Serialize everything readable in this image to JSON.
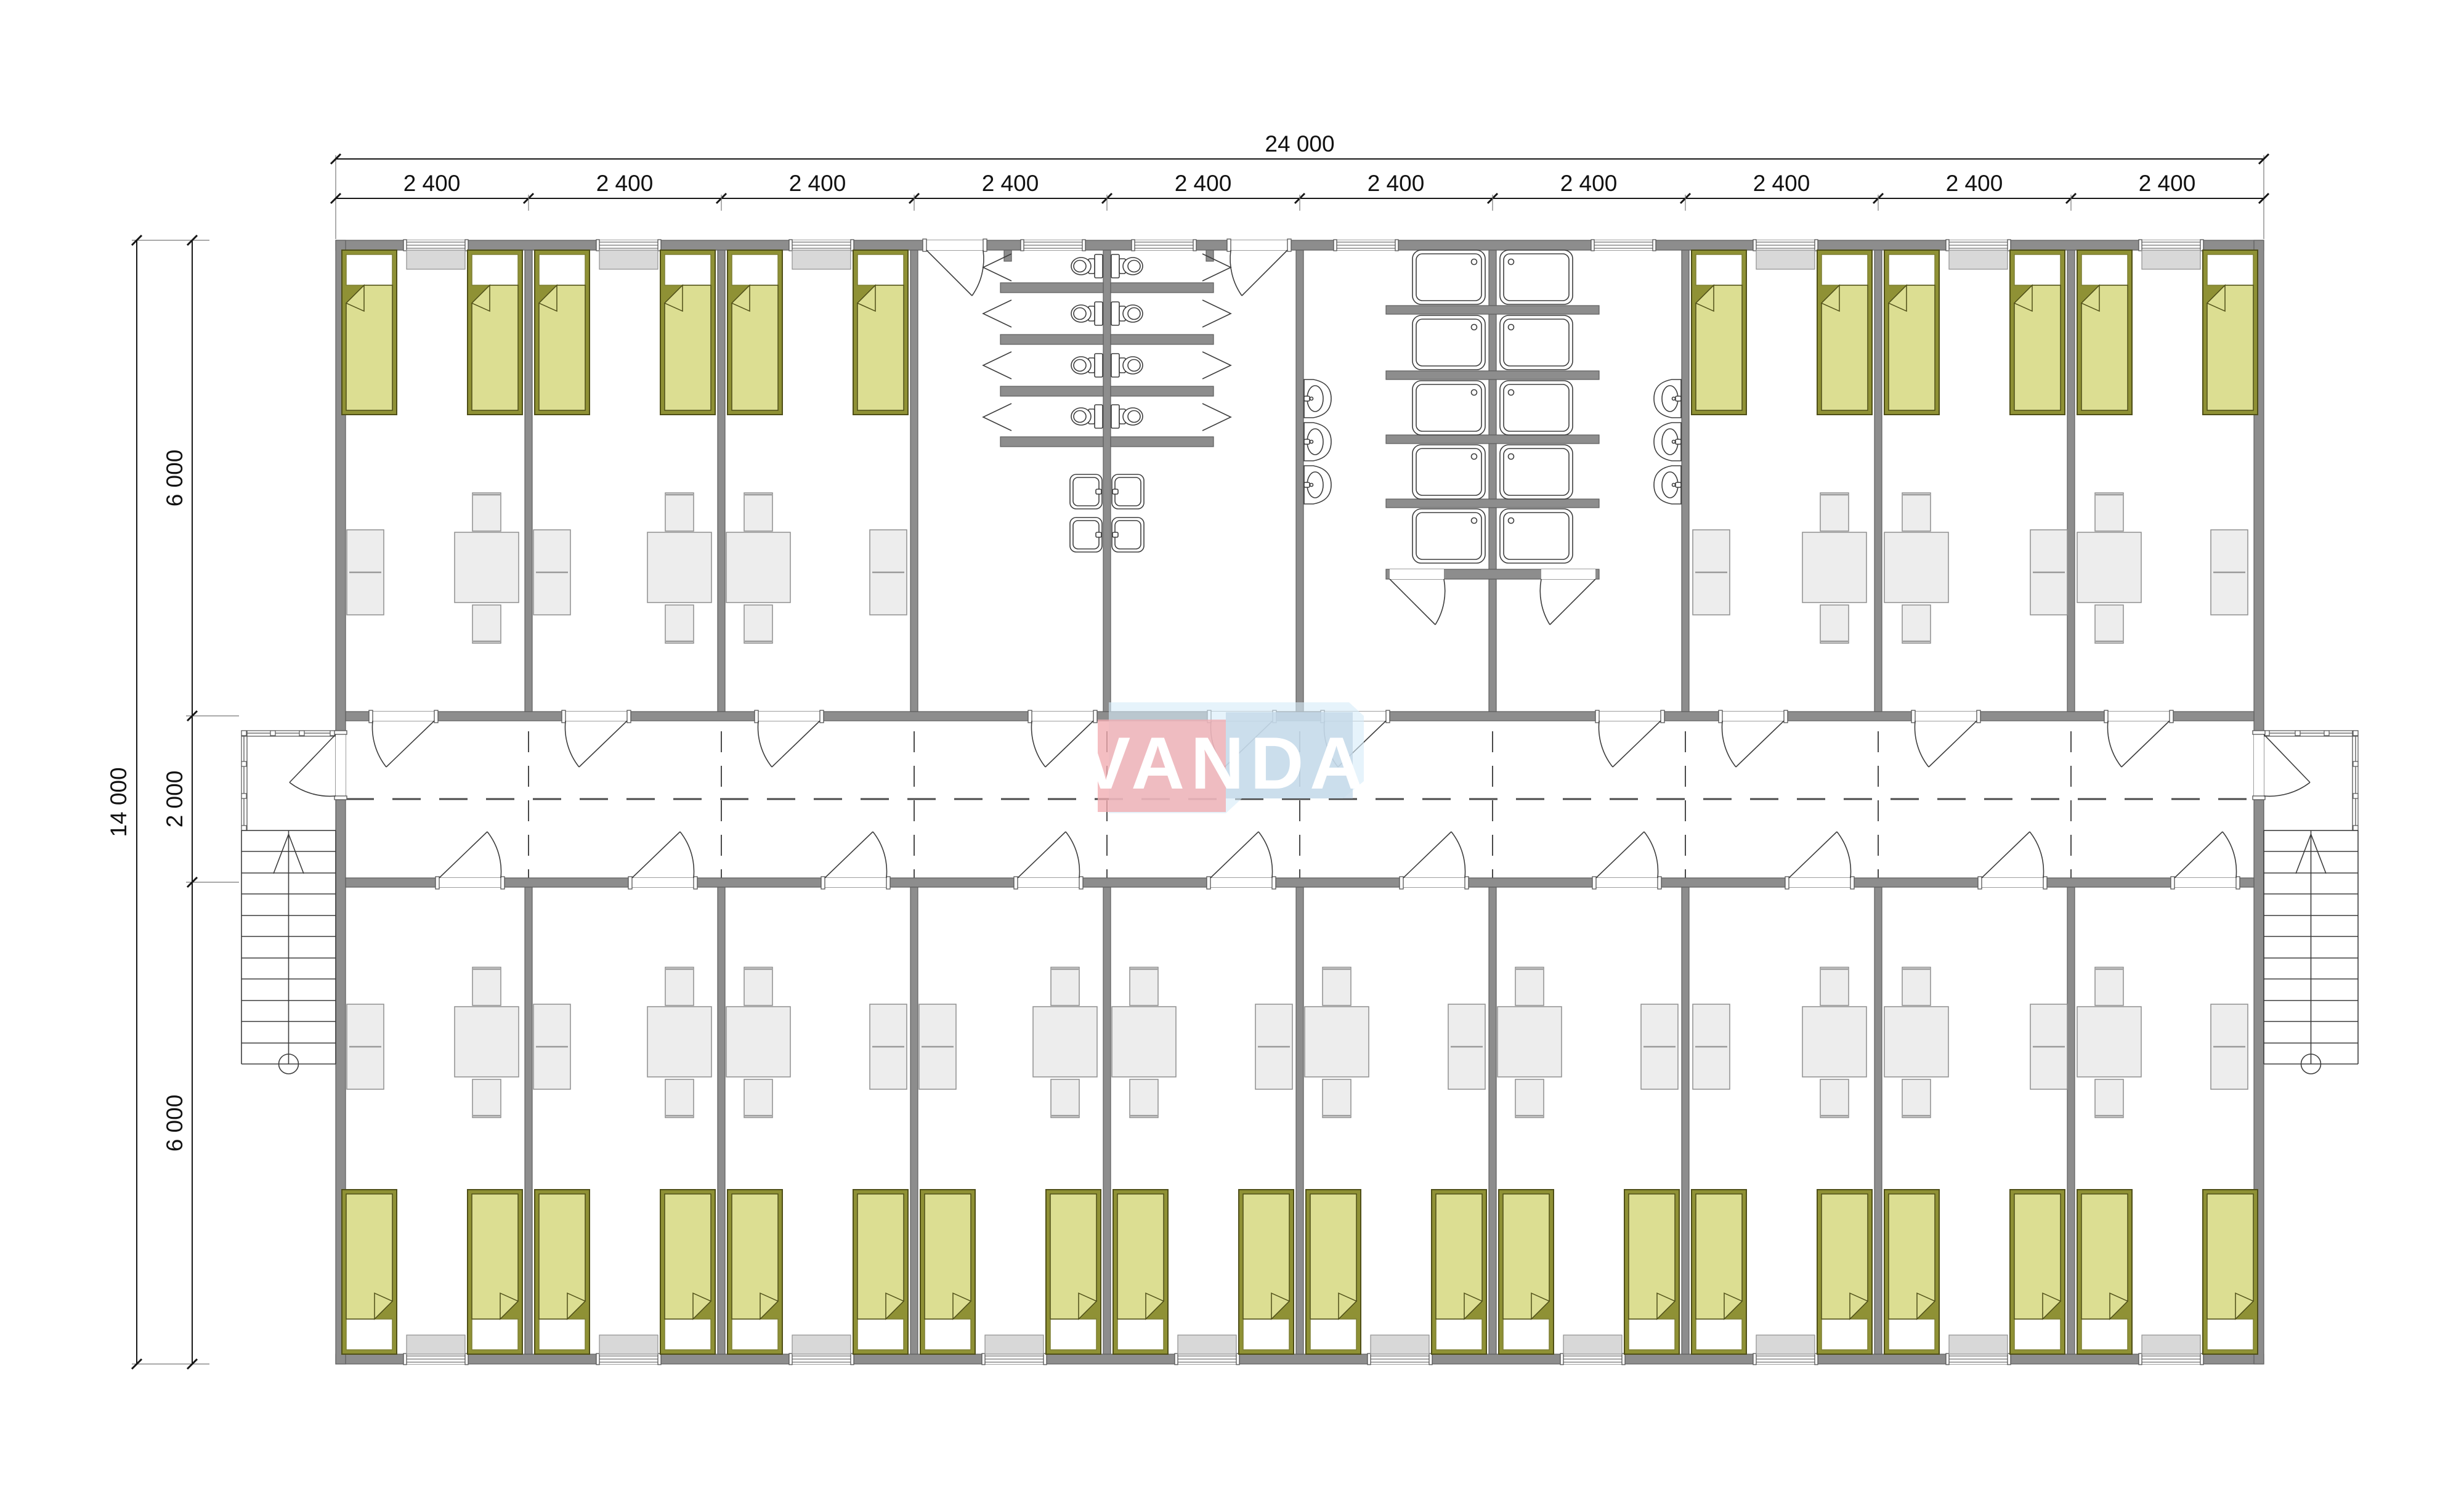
{
  "watermark": {
    "text": "VANDA"
  },
  "dimensions": {
    "top_total": "24 000",
    "top_segments": [
      "2 400",
      "2 400",
      "2 400",
      "2 400",
      "2 400",
      "2 400",
      "2 400",
      "2 400",
      "2 400",
      "2 400"
    ],
    "left_total": "14 000",
    "left_segments": [
      "6 000",
      "2 000",
      "6 000"
    ]
  },
  "colors": {
    "c_wall": "#8d8d8d",
    "c_wall_stroke": "#5e5e5e",
    "c_bed_frame": "#8f9135",
    "c_bed_blanket": "#dcde92",
    "c_bed_stroke": "#4f4f17",
    "c_pillow": "#ffffff",
    "c_furn": "#ededed",
    "c_furn_stroke": "#8f8f8f",
    "c_sill": "#d8d8d8",
    "c_line": "#3d3d3d",
    "c_dim": "#161616",
    "c_logo_pink": "#f1acb1",
    "c_logo_blue": "#c3d7e8",
    "c_logo_blue_light": "#d7ecf8",
    "c_logo_text": "#ffffff"
  }
}
